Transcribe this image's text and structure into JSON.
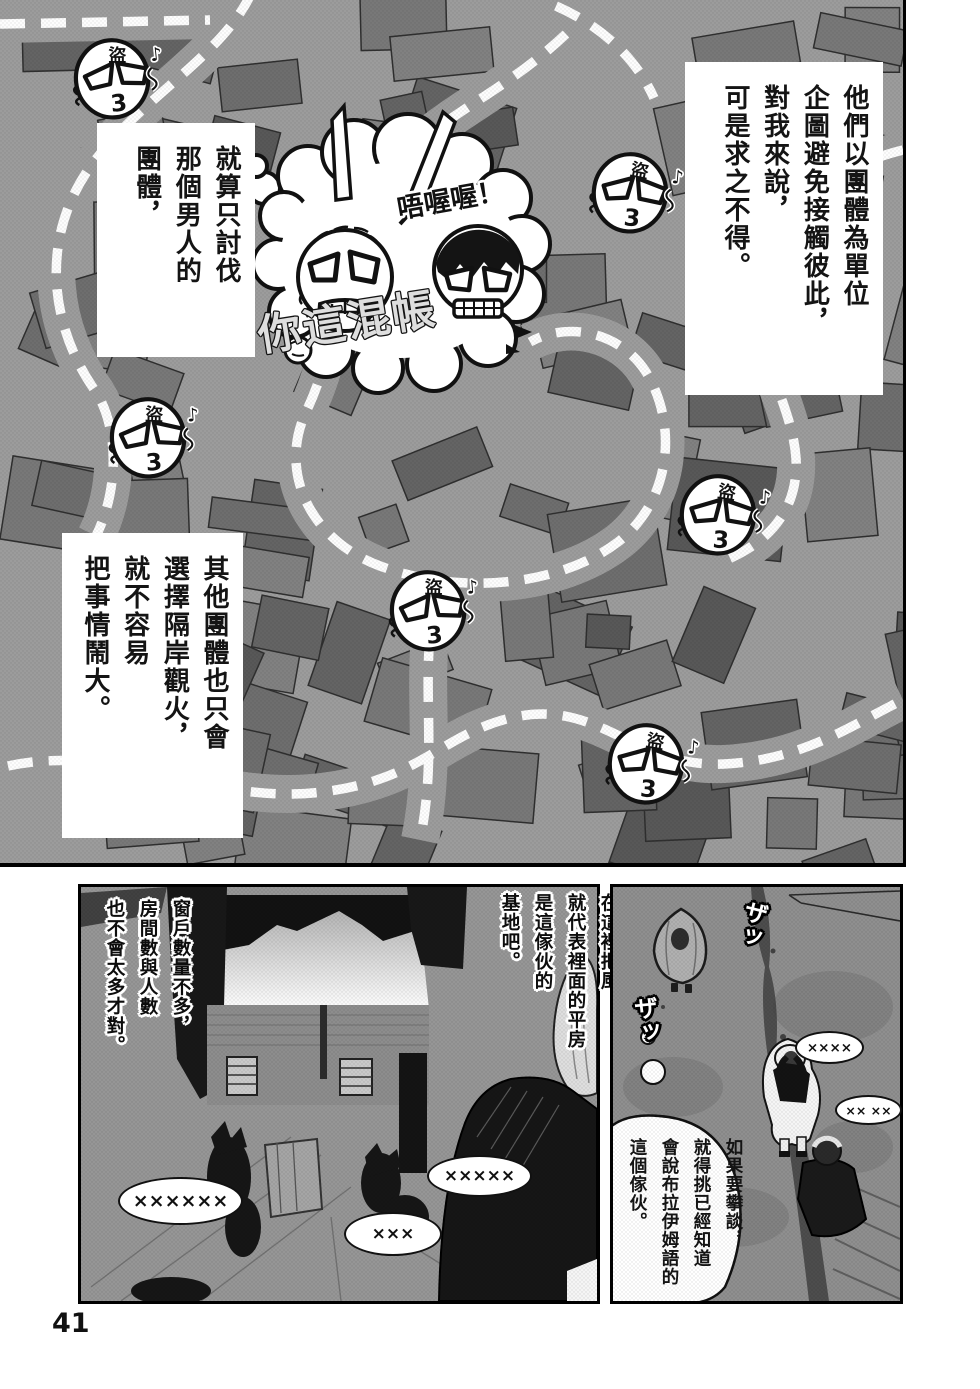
{
  "page": {
    "number": "41"
  },
  "colors": {
    "map_bg": "#9c9c9c",
    "building": "#6e6e6e",
    "ink": "#111111",
    "paper": "#ffffff"
  },
  "map_panel": {
    "caption_top_right": {
      "lines": [
        "他們以團體為單位",
        "企圖避免接觸彼此，",
        "對我來說，",
        "可是求之不得。"
      ]
    },
    "caption_left": {
      "lines": [
        "就算只討伐",
        "那個男人的",
        "團體，"
      ]
    },
    "caption_bottom_left": {
      "lines": [
        "其他團體也只會",
        "選擇隔岸觀火，",
        "就不容易",
        "把事情鬧大。"
      ]
    },
    "fight_cloud": {
      "sfx": "唔喔喔！",
      "shout": "你這混帳"
    },
    "thief_face": {
      "forehead_mark": "盜",
      "mouth": "3",
      "music_note": "♪"
    },
    "thief_faces": [
      {
        "x": 112,
        "y": 78,
        "rot": -6
      },
      {
        "x": 630,
        "y": 192,
        "rot": 5
      },
      {
        "x": 148,
        "y": 437,
        "rot": -4
      },
      {
        "x": 718,
        "y": 514,
        "rot": 3
      },
      {
        "x": 428,
        "y": 610,
        "rot": -5
      },
      {
        "x": 646,
        "y": 763,
        "rot": 4
      }
    ]
  },
  "alley_panel": {
    "caption_right": {
      "lines": [
        "在這裡把風，",
        "就代表裡面的平房",
        "是這傢伙的",
        "基地吧。"
      ]
    },
    "caption_left": {
      "lines": [
        "窗戶數量不多，",
        "房間數與人數",
        "也不會太多才對。"
      ]
    },
    "bubbles": [
      {
        "text": "××××××"
      },
      {
        "text": "×××××"
      },
      {
        "text": "×××"
      }
    ]
  },
  "street_panel": {
    "sfx": [
      {
        "text": "ザッ"
      },
      {
        "text": "ザッ"
      }
    ],
    "bubbles": [
      {
        "text": "××××"
      },
      {
        "text": "×× ××"
      }
    ],
    "thought_bubble": {
      "lines": [
        "如果要攀談，",
        "就得挑已經知道",
        "會說布拉伊姆語的",
        "這個傢伙。"
      ]
    }
  }
}
